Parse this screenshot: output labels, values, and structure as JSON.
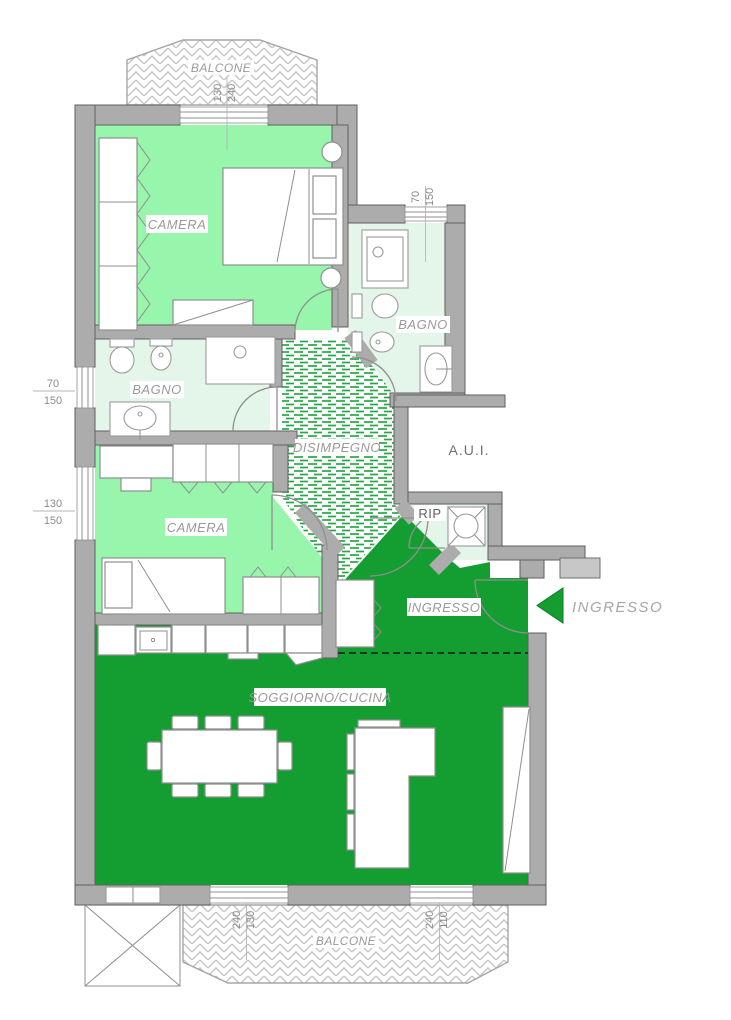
{
  "plan": {
    "rooms": {
      "balcone_top": "BALCONE",
      "camera_1": "CAMERA",
      "bagno_right": "BAGNO",
      "bagno_left": "BAGNO",
      "disimpegno": "DISIMPEGNO",
      "aui": "A.U.I.",
      "rip": "RIP",
      "camera_2": "CAMERA",
      "ingresso": "INGRESSO",
      "soggiorno_cucina": "SOGGIORNO/CUCINA",
      "balcone_bottom": "BALCONE"
    },
    "entrance_arrow_label": "INGRESSO",
    "measurements": {
      "balcony_top_door": {
        "w": "130",
        "h": "240"
      },
      "bagno_right_window": {
        "w": "70",
        "h": "150"
      },
      "left_window_upper": {
        "w": "70",
        "h": "150"
      },
      "left_window_lower": {
        "w": "130",
        "h": "150"
      },
      "bottom_door_left": {
        "w": "130",
        "h": "240"
      },
      "bottom_door_right": {
        "w": "110",
        "h": "240"
      }
    },
    "colors": {
      "room_light_green": "#98f5ac",
      "room_pale_green": "#e3f6e9",
      "room_dark_green": "#149e32",
      "wall_gray": "#acacac",
      "label_gray": "#9a9a9a"
    }
  }
}
